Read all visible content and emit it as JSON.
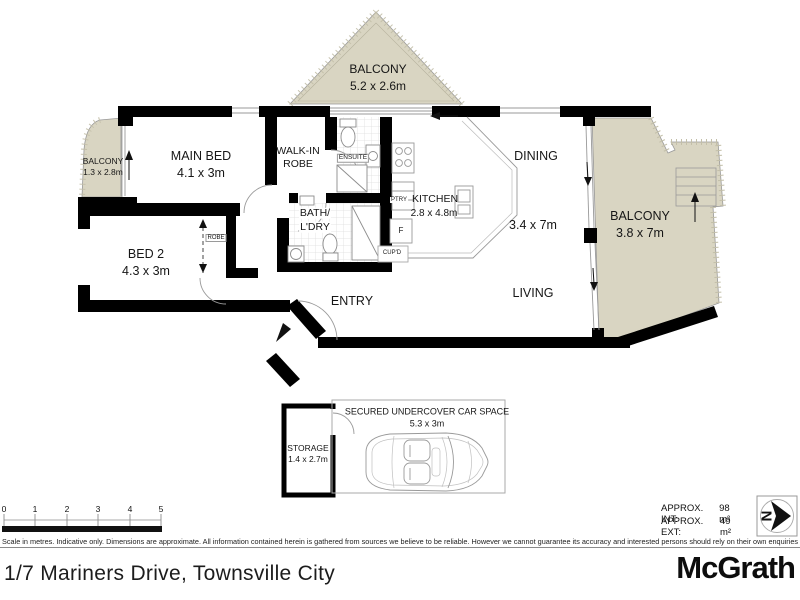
{
  "plan": {
    "rooms": {
      "balcony_top": {
        "label": "BALCONY",
        "dims": "5.2 x 2.6m"
      },
      "balcony_left": {
        "label": "BALCONY",
        "dims": "1.3 x 2.8m"
      },
      "balcony_right": {
        "label": "BALCONY",
        "dims": "3.8 x 7m"
      },
      "main_bed": {
        "label": "MAIN BED",
        "dims": "4.1 x 3m"
      },
      "walk_in_robe": {
        "line1": "WALK-IN",
        "line2": "ROBE"
      },
      "ensuite": {
        "label": "ENSUITE"
      },
      "bath_ldry": {
        "line1": "BATH/",
        "line2": "L'DRY"
      },
      "bed2": {
        "label": "BED 2",
        "dims": "4.3 x 3m"
      },
      "robe": {
        "label": "ROBE"
      },
      "kitchen": {
        "label": "KITCHEN",
        "dims": "2.8 x 4.8m"
      },
      "pantry": {
        "label": "PTRY"
      },
      "fridge": {
        "label": "F"
      },
      "cupboard": {
        "label": "CUP'D"
      },
      "dining": {
        "label": "DINING"
      },
      "living": {
        "label": "LIVING"
      },
      "living_dims": {
        "label": "3.4 x 7m"
      },
      "entry": {
        "label": "ENTRY"
      },
      "storage": {
        "label": "STORAGE",
        "dims": "1.4 x 2.7m"
      },
      "car_space": {
        "label": "SECURED UNDERCOVER CAR SPACE",
        "dims": "5.3 x 3m"
      }
    },
    "scale_bar": {
      "ticks": [
        "0",
        "1",
        "2",
        "3",
        "4",
        "5"
      ]
    },
    "north_label": "N"
  },
  "info": {
    "approx_int_label": "APPROX. INT:",
    "approx_int_value": "98 m²",
    "approx_ext_label": "APPROX. EXT:",
    "approx_ext_value": "49 m²"
  },
  "disclaimer": "Scale in metres. Indicative only. Dimensions are approximate. All information contained herein is gathered from sources we believe to be reliable. However we cannot guarantee its accuracy and interested persons should rely on their own enquiries",
  "footer": {
    "address": "1/7 Mariners Drive, Townsville City",
    "brand": "McGrath"
  },
  "colors": {
    "balcony_fill": "#d9d5c2",
    "wall": "#000000",
    "thin_line": "#8c8c8c"
  }
}
